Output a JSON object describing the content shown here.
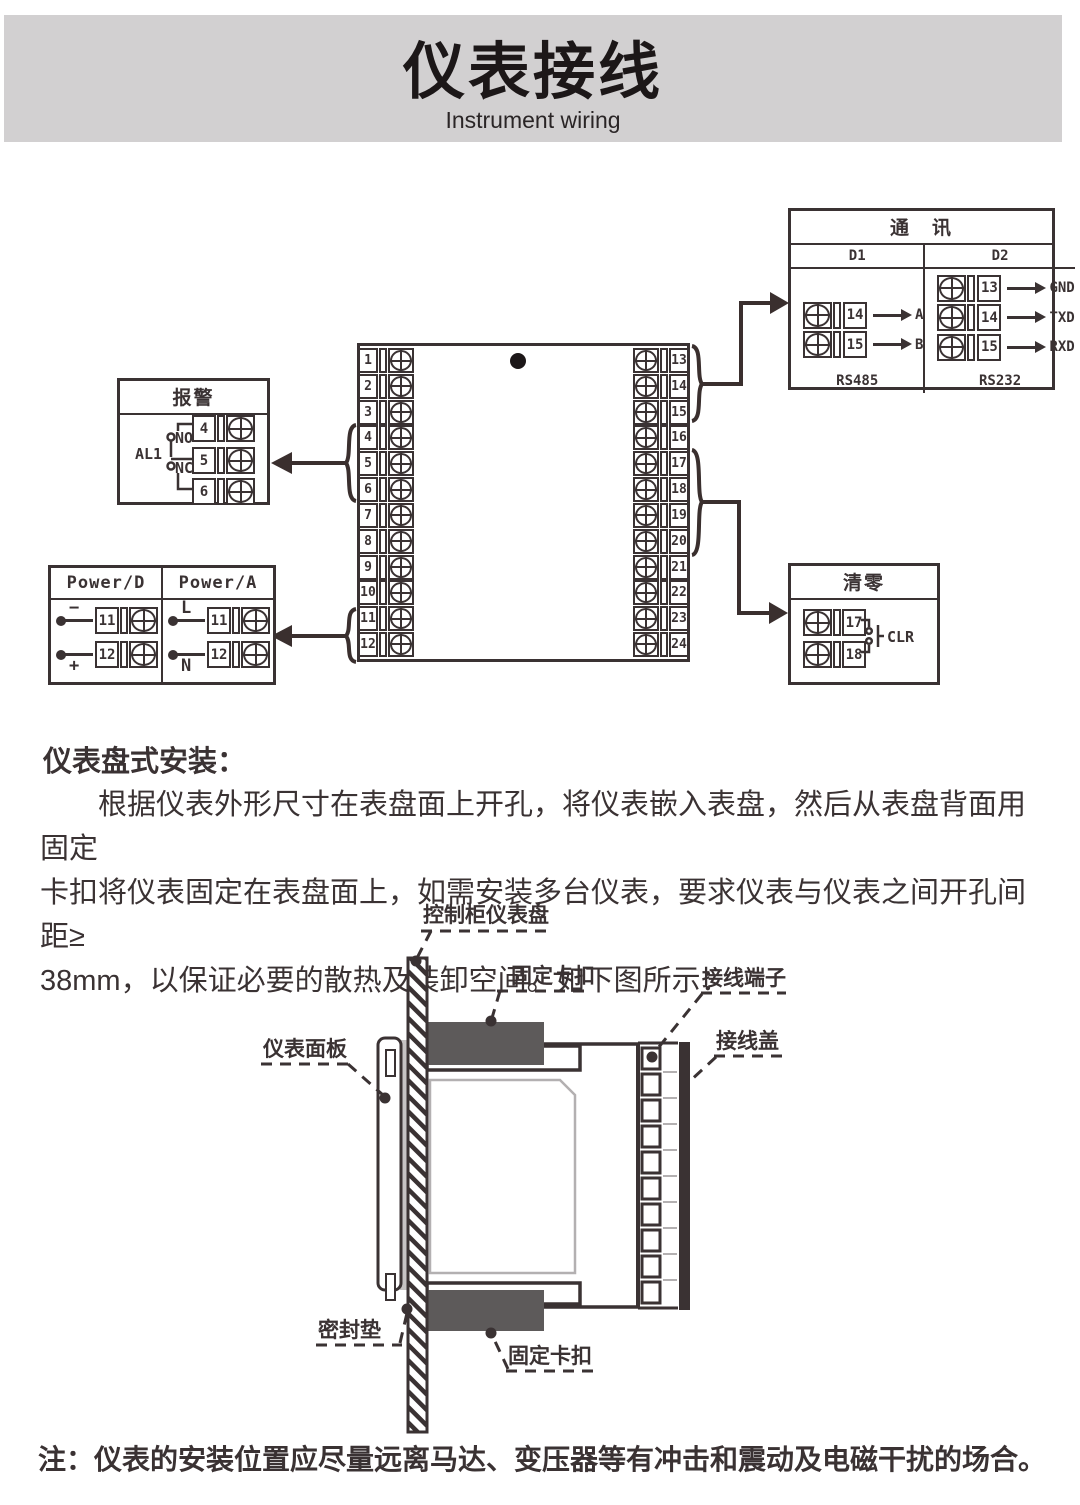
{
  "header": {
    "title": "仪表接线",
    "subtitle": "Instrument wiring"
  },
  "wiring": {
    "comm": {
      "title": "通　讯",
      "d1": {
        "header": "D1",
        "footer": "RS485",
        "rows": [
          {
            "num": "14",
            "label": "A"
          },
          {
            "num": "15",
            "label": "B"
          }
        ]
      },
      "d2": {
        "header": "D2",
        "footer": "RS232",
        "rows": [
          {
            "num": "13",
            "label": "GND"
          },
          {
            "num": "14",
            "label": "TXD"
          },
          {
            "num": "15",
            "label": "RXD"
          }
        ]
      }
    },
    "alarm": {
      "title": "报警",
      "relay": "AL1",
      "no": "NO",
      "nc": "NC",
      "terminals": [
        "4",
        "5",
        "6"
      ]
    },
    "power": {
      "d": {
        "header": "Power/D",
        "rows": [
          {
            "wire": "−",
            "num": "11"
          },
          {
            "wire": "+",
            "num": "12"
          }
        ]
      },
      "a": {
        "header": "Power/A",
        "rows": [
          {
            "wire": "L",
            "num": "11"
          },
          {
            "wire": "N",
            "num": "12"
          }
        ]
      }
    },
    "clear": {
      "title": "清零",
      "signal": "CLR",
      "terminals": [
        "17",
        "18"
      ]
    },
    "block": {
      "left": [
        "1",
        "2",
        "3",
        "4",
        "5",
        "6",
        "7",
        "8",
        "9",
        "10",
        "11",
        "12"
      ],
      "right": [
        "13",
        "14",
        "15",
        "16",
        "17",
        "18",
        "19",
        "20",
        "21",
        "22",
        "23",
        "24"
      ]
    }
  },
  "install": {
    "heading": "仪表盘式安装：",
    "lines": [
      "根据仪表外形尺寸在表盘面上开孔，将仪表嵌入表盘，然后从表盘背面用固定",
      "卡扣将仪表固定在表盘面上，如需安装多台仪表，要求仪表与仪表之间开孔间距≥",
      "38mm，以保证必要的散热及装卸空间。如下图所示："
    ]
  },
  "mount": {
    "labels": {
      "panel": "控制柜仪表盘",
      "clip_top": "固定卡扣",
      "terminals": "接线端子",
      "cover": "接线盖",
      "front_panel": "仪表面板",
      "gasket": "密封垫",
      "clip_bottom": "固定卡扣"
    }
  },
  "note": "注：仪表的安装位置应尽量远离马达、变压器等有冲击和震动及电磁干扰的场合。",
  "colors": {
    "ink": "#3a3233",
    "band": "#d2d0d1",
    "clamp": "#5d5a5a",
    "gasket": "#c6c3c4"
  }
}
